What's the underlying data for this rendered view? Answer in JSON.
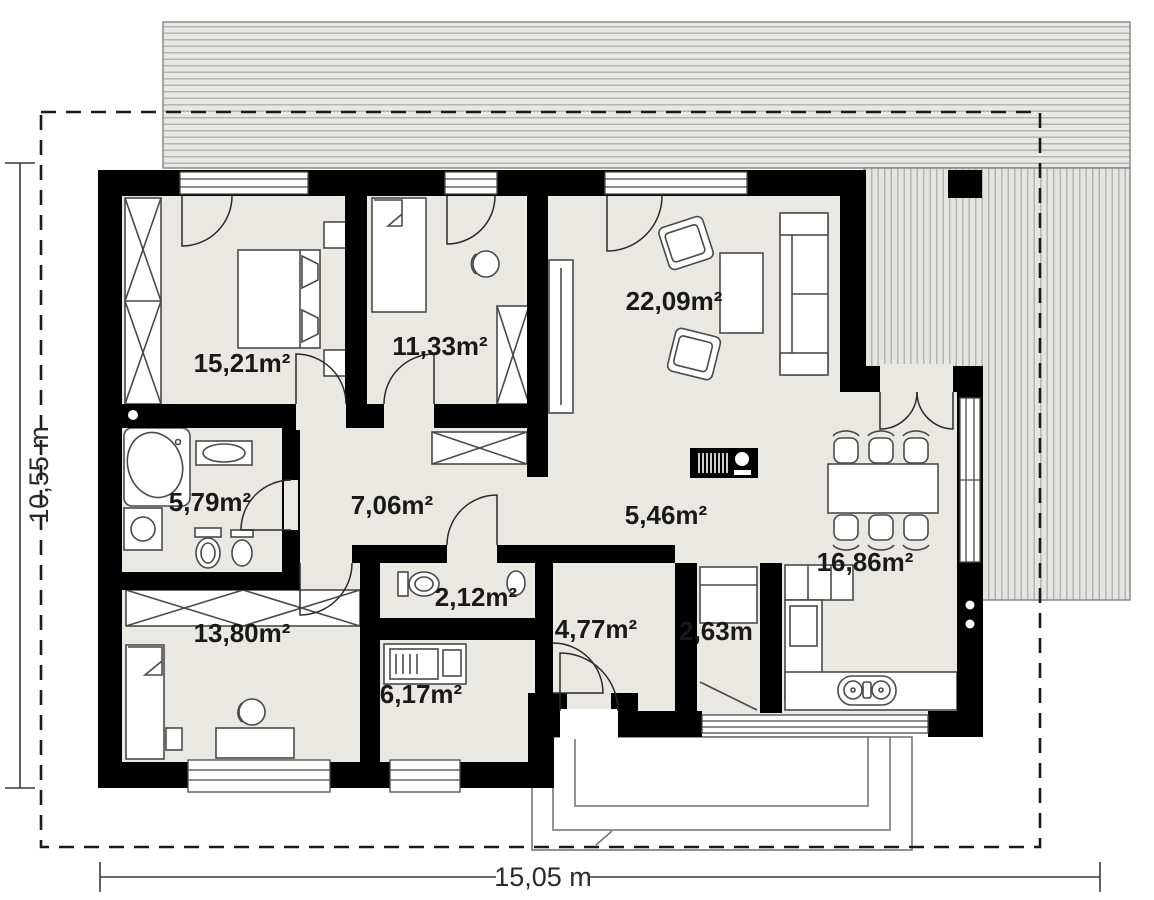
{
  "plan": {
    "type": "floor-plan",
    "dimensions": {
      "height_label": "10,55 m",
      "width_label": "15,05 m"
    },
    "rooms": [
      {
        "name": "bedroom-1",
        "area": "15,21m²"
      },
      {
        "name": "bedroom-2",
        "area": "11,33m²"
      },
      {
        "name": "living-room",
        "area": "22,09m²"
      },
      {
        "name": "bathroom",
        "area": "5,79m²"
      },
      {
        "name": "hallway",
        "area": "7,06m²"
      },
      {
        "name": "entry-hall",
        "area": "5,46m²"
      },
      {
        "name": "dining-kitchen",
        "area": "16,86m²"
      },
      {
        "name": "wc",
        "area": "2,12m²"
      },
      {
        "name": "bedroom-3",
        "area": "13,80m²"
      },
      {
        "name": "wardrobe-room",
        "area": "4,77m²"
      },
      {
        "name": "closet",
        "area": "2,63m"
      },
      {
        "name": "utility-room",
        "area": "6,17m²"
      }
    ],
    "colors": {
      "wall": "#000000",
      "floor": "#e9e8e3",
      "hatch_bg": "#e7e7e4",
      "hatch_line": "#b4b4b1",
      "hatch_outline": "#8a8a8a",
      "furniture_line": "#4a4a4a",
      "label": "#191919",
      "boundary": "#1a1a1a"
    }
  }
}
